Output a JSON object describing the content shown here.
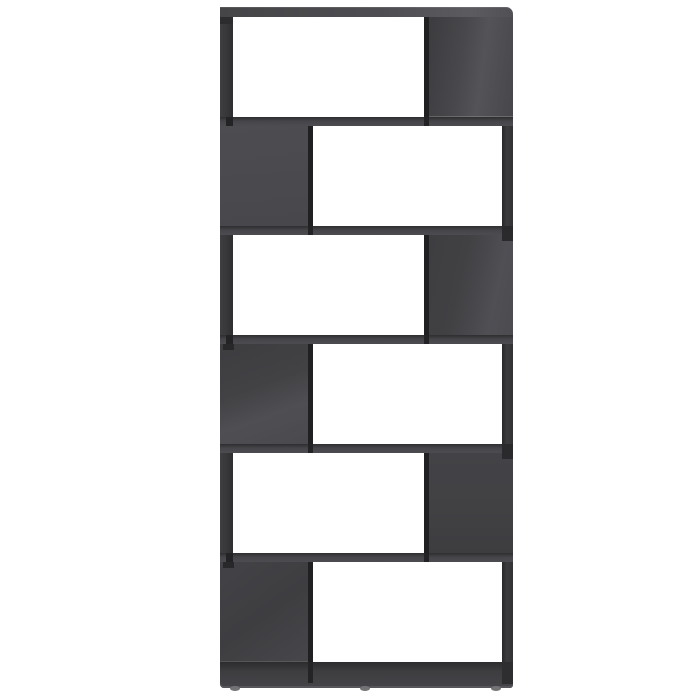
{
  "scene": {
    "type": "product-photo",
    "subject": "High gloss gray book cabinet room divider with six offset open compartments arranged in a zig-zag pattern, standing on small round feet against a plain white background",
    "background_color": "#ffffff"
  },
  "bookcase": {
    "finish": "high-gloss-gray",
    "compartment_count": 6,
    "colors": {
      "panel_base": "#434346",
      "panel_light": "#55555a",
      "panel_dark": "#39393c",
      "shelf_front": "#4a4a4e",
      "edge_shadow": "#202022",
      "side_edge": "#38383b",
      "base_panel": "#3d3d40",
      "base_highlight": "#55555a",
      "foot": "#737376",
      "opening": "#ffffff"
    },
    "rows": [
      {
        "label": "compartment-1",
        "opening_side": "left"
      },
      {
        "label": "compartment-2",
        "opening_side": "right"
      },
      {
        "label": "compartment-3",
        "opening_side": "left"
      },
      {
        "label": "compartment-4",
        "opening_side": "right"
      },
      {
        "label": "compartment-5",
        "opening_side": "left"
      },
      {
        "label": "compartment-6",
        "opening_side": "right"
      }
    ],
    "feet": [
      {
        "position_left_px": 10
      },
      {
        "position_left_px": 140
      },
      {
        "position_left_px": 271
      }
    ]
  }
}
